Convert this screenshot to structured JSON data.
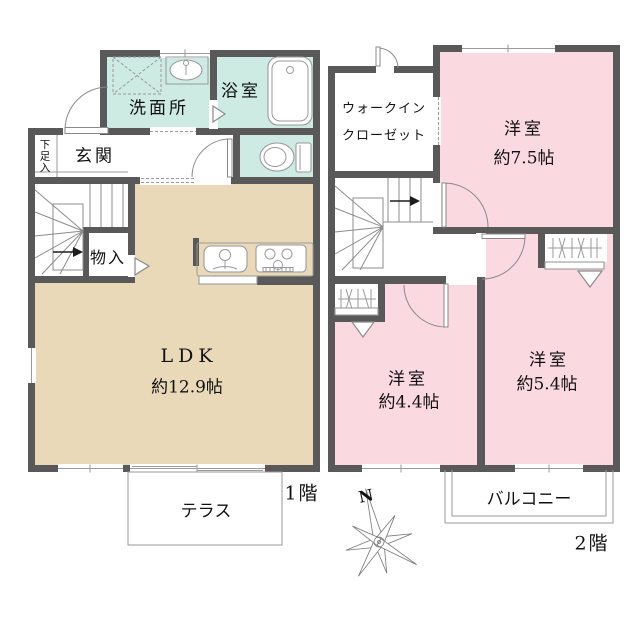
{
  "floor1": {
    "floor_label": "1階",
    "rooms": {
      "washroom": "洗面所",
      "bathroom": "浴室",
      "entrance": "玄関",
      "shoe_storage": "下足入",
      "storage": "物入",
      "ldk_name": "LDK",
      "ldk_size": "約12.9帖",
      "terrace": "テラス"
    }
  },
  "floor2": {
    "floor_label": "2階",
    "rooms": {
      "wic_line1": "ウォークイン",
      "wic_line2": "クローゼット",
      "bedroom_a_name": "洋室",
      "bedroom_a_size": "約7.5帖",
      "bedroom_b_name": "洋室",
      "bedroom_b_size": "約4.4帖",
      "bedroom_c_name": "洋室",
      "bedroom_c_size": "約5.4帖",
      "balcony": "バルコニー"
    }
  },
  "compass": {
    "north": "N"
  },
  "colors": {
    "wall": "#595959",
    "wet_area": "#cdebe3",
    "ldk_floor": "#e9d9b8",
    "bedroom_floor": "#fbd9e1",
    "outline": "#8c8c8c",
    "background": "#ffffff"
  }
}
